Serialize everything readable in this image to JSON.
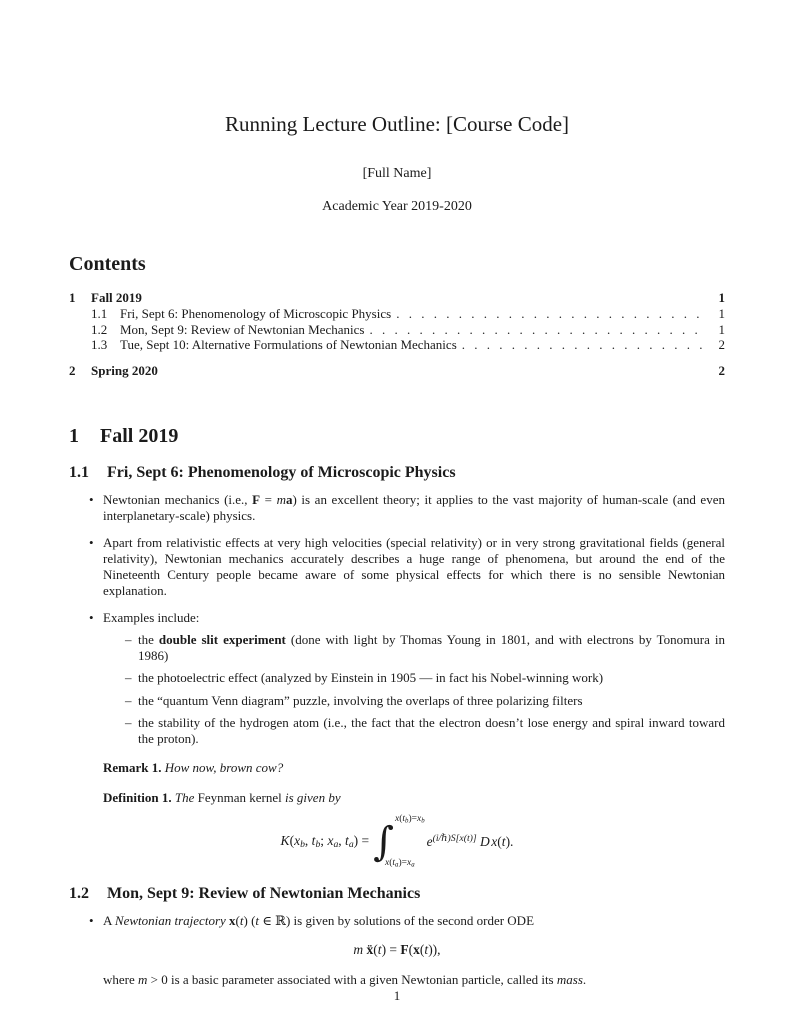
{
  "icons": {
    "bullet": "•",
    "dash": "–"
  },
  "doc": {
    "title": "Running Lecture Outline: [Course Code]",
    "author": "[Full Name]",
    "date": "Academic Year 2019-2020",
    "page_number": "1"
  },
  "toc": {
    "heading": "Contents",
    "entries": [
      {
        "number": "1",
        "label": "Fall 2019",
        "page": "1"
      },
      {
        "number": "1.1",
        "label": "Fri, Sept 6: Phenomenology of Microscopic Physics",
        "page": "1"
      },
      {
        "number": "1.2",
        "label": "Mon, Sept 9: Review of Newtonian Mechanics",
        "page": "1"
      },
      {
        "number": "1.3",
        "label": "Tue, Sept 10: Alternative Formulations of Newtonian Mechanics",
        "page": "2"
      },
      {
        "number": "2",
        "label": "Spring 2020",
        "page": "2"
      }
    ]
  },
  "section1": {
    "number": "1",
    "title": "Fall 2019"
  },
  "sec11": {
    "number": "1.1",
    "title": "Fri, Sept 6: Phenomenology of Microscopic Physics",
    "bullet1_runs": [
      {
        "t": "Newtonian mechanics (i.e., ",
        "s": "rm"
      },
      {
        "t": "F",
        "s": "bf"
      },
      {
        "t": " = ",
        "s": "rm"
      },
      {
        "t": "m",
        "s": "it"
      },
      {
        "t": "a",
        "s": "bf"
      },
      {
        "t": ") is an excellent theory; it applies to the vast majority of human-scale (and even interplanetary-scale) physics.",
        "s": "rm"
      }
    ],
    "bullet2": "Apart from relativistic effects at very high velocities (special relativity) or in very strong gravitational fields (general relativity), Newtonian mechanics accurately describes a huge range of phenomena, but around the end of the Nineteenth Century people became aware of some physical effects for which there is no sensible Newtonian explanation.",
    "bullet3": "Examples include:",
    "sub1_runs": [
      {
        "t": "the ",
        "s": "rm"
      },
      {
        "t": "double slit experiment",
        "s": "bf"
      },
      {
        "t": " (done with light by Thomas Young in 1801, and with electrons by Tonomura in 1986)",
        "s": "rm"
      }
    ],
    "sub2": "the photoelectric effect (analyzed by Einstein in 1905 — in fact his Nobel-winning work)",
    "sub3": "the “quantum Venn diagram” puzzle, involving the overlaps of three polarizing filters",
    "sub4": "the stability of the hydrogen atom (i.e., the fact that the electron doesn’t lose energy and spiral inward toward the proton).",
    "remark_runs": [
      {
        "t": "Remark 1.",
        "s": "bf"
      },
      {
        "t": " How now, brown cow?",
        "s": "it"
      }
    ],
    "definition_runs": [
      {
        "t": "Definition 1.",
        "s": "bf"
      },
      {
        "t": " The ",
        "s": "it"
      },
      {
        "t": "Feynman kernel",
        "s": "rm"
      },
      {
        "t": " is given by",
        "s": "it"
      }
    ],
    "integral_sign": "∫",
    "eq_lhs_runs": [
      {
        "t": "K",
        "s": "it"
      },
      {
        "t": "(",
        "s": "rm"
      },
      {
        "t": "x",
        "s": "it"
      },
      {
        "t": "b",
        "s": "it sub"
      },
      {
        "t": ", ",
        "s": "rm"
      },
      {
        "t": "t",
        "s": "it"
      },
      {
        "t": "b",
        "s": "it sub"
      },
      {
        "t": "; ",
        "s": "rm"
      },
      {
        "t": "x",
        "s": "it"
      },
      {
        "t": "a",
        "s": "it sub"
      },
      {
        "t": ", ",
        "s": "rm"
      },
      {
        "t": "t",
        "s": "it"
      },
      {
        "t": "a",
        "s": "it sub"
      },
      {
        "t": ") = ",
        "s": "rm"
      }
    ],
    "eq_upper_runs": [
      {
        "t": "x",
        "s": "it"
      },
      {
        "t": "(",
        "s": "rm"
      },
      {
        "t": "t",
        "s": "it"
      },
      {
        "t": "b",
        "s": "it sub"
      },
      {
        "t": ")=",
        "s": "rm"
      },
      {
        "t": "x",
        "s": "it"
      },
      {
        "t": "b",
        "s": "it sub"
      }
    ],
    "eq_lower_runs": [
      {
        "t": "x",
        "s": "it"
      },
      {
        "t": "(",
        "s": "rm"
      },
      {
        "t": "t",
        "s": "it"
      },
      {
        "t": "a",
        "s": "it sub"
      },
      {
        "t": ")=",
        "s": "rm"
      },
      {
        "t": "x",
        "s": "it"
      },
      {
        "t": "a",
        "s": "it sub"
      }
    ],
    "eq_rhs_runs": [
      {
        "t": "e",
        "s": "it"
      },
      {
        "t": "(i/ℏ)S[x(t)]",
        "s": "sup it"
      },
      {
        "t": " ",
        "s": "rm"
      },
      {
        "t": "D",
        "s": "scriptD"
      },
      {
        "t": "x",
        "s": "it"
      },
      {
        "t": "(",
        "s": "rm"
      },
      {
        "t": "t",
        "s": "it"
      },
      {
        "t": ").",
        "s": "rm"
      }
    ]
  },
  "sec12": {
    "number": "1.2",
    "title": "Mon, Sept 9: Review of Newtonian Mechanics",
    "bullet1_runs": [
      {
        "t": "A ",
        "s": "rm"
      },
      {
        "t": "Newtonian trajectory",
        "s": "it"
      },
      {
        "t": " ",
        "s": "rm"
      },
      {
        "t": "x",
        "s": "bf"
      },
      {
        "t": "(",
        "s": "rm"
      },
      {
        "t": "t",
        "s": "it"
      },
      {
        "t": ") (",
        "s": "rm"
      },
      {
        "t": "t",
        "s": "it"
      },
      {
        "t": " ∈ ℝ) is given by solutions of the second order ODE",
        "s": "rm"
      }
    ],
    "eq_runs": [
      {
        "t": "m",
        "s": "it"
      },
      {
        "t": " ",
        "s": "rm"
      },
      {
        "t": "ẍ",
        "s": "bf"
      },
      {
        "t": "(",
        "s": "rm"
      },
      {
        "t": "t",
        "s": "it"
      },
      {
        "t": ") = ",
        "s": "rm"
      },
      {
        "t": "F",
        "s": "bf"
      },
      {
        "t": "(",
        "s": "rm"
      },
      {
        "t": "x",
        "s": "bf"
      },
      {
        "t": "(",
        "s": "rm"
      },
      {
        "t": "t",
        "s": "it"
      },
      {
        "t": ")),",
        "s": "rm"
      }
    ],
    "after_runs": [
      {
        "t": "where ",
        "s": "rm"
      },
      {
        "t": "m",
        "s": "it"
      },
      {
        "t": " > 0 is a basic parameter associated with a given Newtonian particle, called its ",
        "s": "rm"
      },
      {
        "t": "mass",
        "s": "it"
      },
      {
        "t": ".",
        "s": "rm"
      }
    ]
  }
}
